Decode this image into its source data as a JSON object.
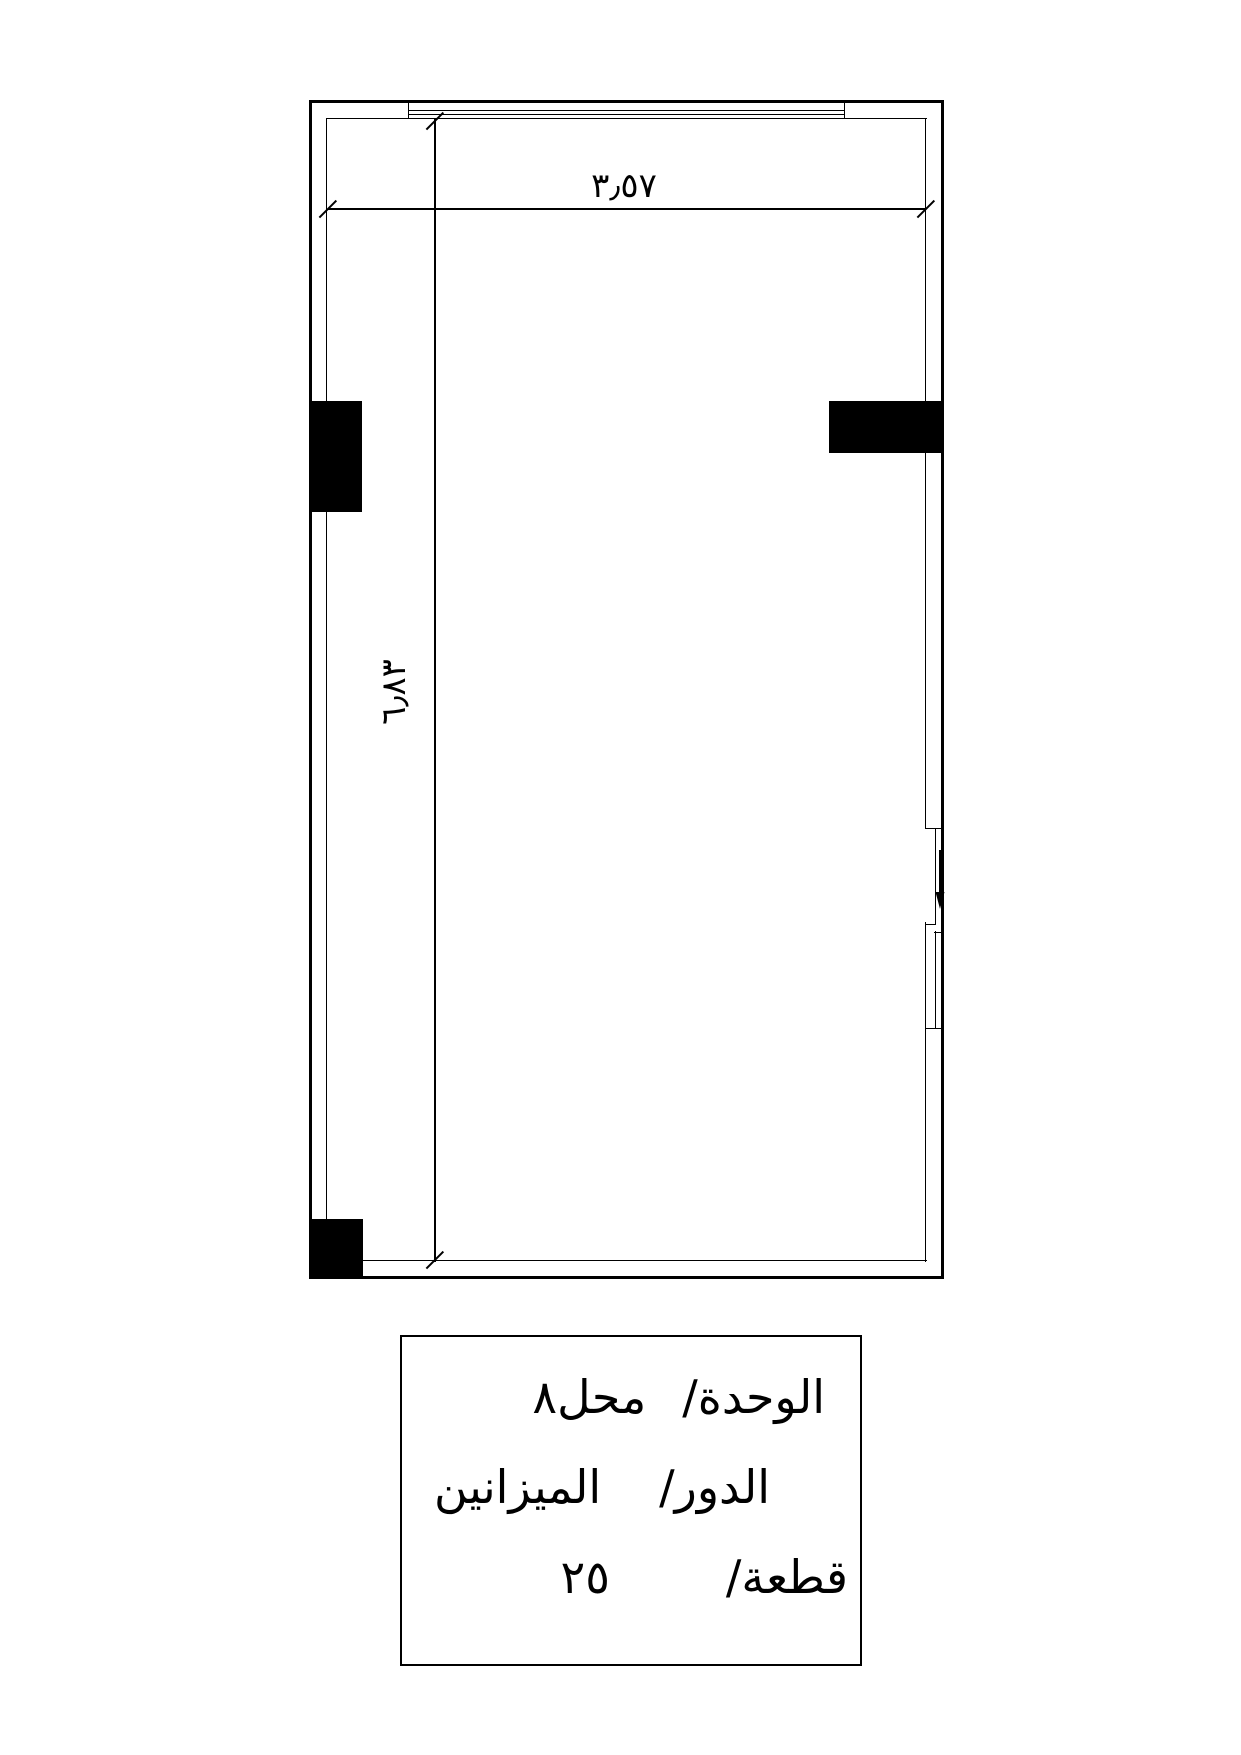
{
  "dimensions": {
    "width_label": "٣٫٥٧",
    "height_label": "٦٫٨٣"
  },
  "title_block": {
    "unit": {
      "label": "الوحدة/",
      "value": "محل٨"
    },
    "floor": {
      "label": "الدور/",
      "value": "الميزانين"
    },
    "plot": {
      "label": "قطعة/",
      "value": "٢٥"
    }
  },
  "icons": {
    "entry_arrow_icon": "↓"
  },
  "colors": {
    "line": "#000000",
    "column_fill": "#000000",
    "background": "#ffffff"
  }
}
